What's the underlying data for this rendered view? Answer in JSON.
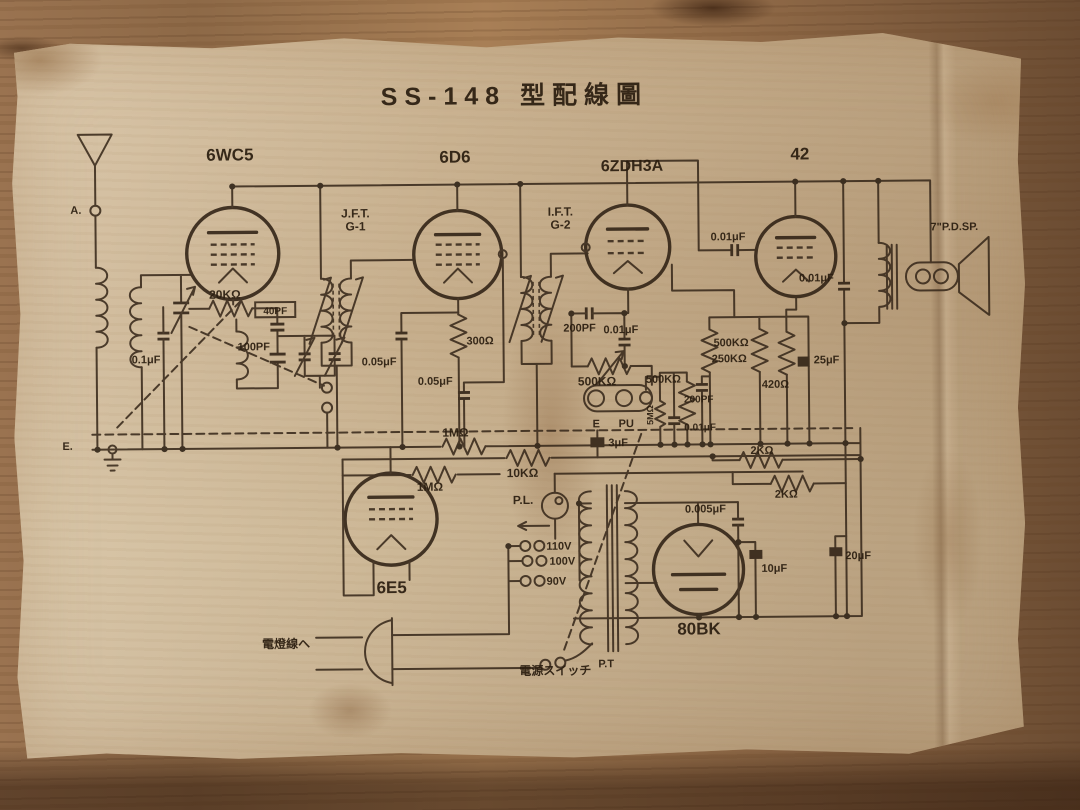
{
  "scene": {
    "description": "Vintage Japanese vacuum-tube radio wiring diagram (SS-148) printed on aged paper lying on a wooden table",
    "paper_color": "#c9b392",
    "wood_color": "#8d6947",
    "ink_color": "#38291b"
  },
  "schematic": {
    "title": "SS-148 型配線圖",
    "labels": [
      {
        "n": "schematic-title",
        "t": "SS-148 型配線圖",
        "x": 505,
        "y": 70,
        "s": 25,
        "a": "m",
        "ls": 7
      },
      {
        "n": "tube-label-6wc5",
        "t": "6WC5",
        "x": 220,
        "y": 124,
        "s": 17,
        "a": "m"
      },
      {
        "n": "tube-label-6d6",
        "t": "6D6",
        "x": 445,
        "y": 128,
        "s": 17,
        "a": "m"
      },
      {
        "n": "tube-label-6zdh3a",
        "t": "6ZDH3A",
        "x": 622,
        "y": 138,
        "s": 16,
        "a": "m"
      },
      {
        "n": "tube-label-42",
        "t": "42",
        "x": 790,
        "y": 128,
        "s": 17,
        "a": "m"
      },
      {
        "n": "tube-label-6e5",
        "t": "6E5",
        "x": 378,
        "y": 558,
        "s": 17,
        "a": "m"
      },
      {
        "n": "tube-label-80bk",
        "t": "80BK",
        "x": 685,
        "y": 602,
        "s": 17,
        "a": "m"
      },
      {
        "n": "label-jft",
        "t": "J.F.T.",
        "x": 345,
        "y": 182,
        "s": 12,
        "a": "m"
      },
      {
        "n": "label-jft-g1",
        "t": "G-1",
        "x": 345,
        "y": 195,
        "s": 12,
        "a": "m"
      },
      {
        "n": "label-ift",
        "t": "I.F.T.",
        "x": 550,
        "y": 182,
        "s": 12,
        "a": "m"
      },
      {
        "n": "label-ift-g2",
        "t": "G-2",
        "x": 550,
        "y": 195,
        "s": 12,
        "a": "m"
      },
      {
        "n": "label-speaker",
        "t": "7\"P.D.SP.",
        "x": 920,
        "y": 200,
        "s": 11
      },
      {
        "n": "label-terminal-a",
        "t": "A.",
        "x": 60,
        "y": 176,
        "s": 11
      },
      {
        "n": "label-terminal-e",
        "t": "E.",
        "x": 50,
        "y": 412,
        "s": 11
      },
      {
        "n": "label-cap-0-1uf",
        "t": "0.1μF",
        "x": 120,
        "y": 326,
        "s": 11
      },
      {
        "n": "label-res-20k",
        "t": "20KΩ",
        "x": 198,
        "y": 262,
        "s": 12
      },
      {
        "n": "label-cap-40pf",
        "t": "40PF",
        "x": 264,
        "y": 278,
        "s": 10,
        "a": "m"
      },
      {
        "n": "label-cap-100pf",
        "t": "100PF",
        "x": 226,
        "y": 314,
        "s": 11
      },
      {
        "n": "label-cap-005uf-1",
        "t": "0.05μF",
        "x": 350,
        "y": 330,
        "s": 11
      },
      {
        "n": "label-res-300",
        "t": "300Ω",
        "x": 455,
        "y": 310,
        "s": 11
      },
      {
        "n": "label-cap-005uf-2",
        "t": "0.05μF",
        "x": 406,
        "y": 350,
        "s": 11
      },
      {
        "n": "label-cap-200pf-1",
        "t": "200PF",
        "x": 552,
        "y": 298,
        "s": 11
      },
      {
        "n": "label-cap-001uf-1",
        "t": "0.01μF",
        "x": 592,
        "y": 300,
        "s": 11
      },
      {
        "n": "label-pot-500k",
        "t": "500KΩ",
        "x": 566,
        "y": 352,
        "s": 12
      },
      {
        "n": "label-jack-e",
        "t": "E",
        "x": 584,
        "y": 394,
        "s": 11,
        "a": "m"
      },
      {
        "n": "label-jack-pu",
        "t": "PU",
        "x": 614,
        "y": 394,
        "s": 11,
        "a": "m"
      },
      {
        "n": "label-res-500k-avc",
        "t": "500KΩ",
        "x": 634,
        "y": 350,
        "s": 11
      },
      {
        "n": "label-res-5m",
        "t": "5MΩ",
        "x": 641,
        "y": 392,
        "s": 9,
        "r": -90
      },
      {
        "n": "label-cap-001uf-2",
        "t": "0.01μF",
        "x": 672,
        "y": 398,
        "s": 10
      },
      {
        "n": "label-res-500k-b",
        "t": "500KΩ",
        "x": 702,
        "y": 314,
        "s": 11
      },
      {
        "n": "label-res-250k",
        "t": "250KΩ",
        "x": 700,
        "y": 330,
        "s": 11
      },
      {
        "n": "label-cap-200pf-2",
        "t": "200PF",
        "x": 672,
        "y": 370,
        "s": 10
      },
      {
        "n": "label-res-420",
        "t": "420Ω",
        "x": 750,
        "y": 356,
        "s": 11
      },
      {
        "n": "label-cap-25uf",
        "t": "25μF",
        "x": 802,
        "y": 332,
        "s": 11
      },
      {
        "n": "label-cap-001uf-3",
        "t": "0.01μF",
        "x": 700,
        "y": 208,
        "s": 11
      },
      {
        "n": "label-cap-001uf-4",
        "t": "0.01μF",
        "x": 788,
        "y": 250,
        "s": 11
      },
      {
        "n": "label-cap-3uf",
        "t": "3μF",
        "x": 596,
        "y": 413,
        "s": 11
      },
      {
        "n": "label-res-2k-1",
        "t": "2KΩ",
        "x": 738,
        "y": 422,
        "s": 11
      },
      {
        "n": "label-res-2k-2",
        "t": "2KΩ",
        "x": 762,
        "y": 466,
        "s": 11
      },
      {
        "n": "label-res-1m-1",
        "t": "1MΩ",
        "x": 430,
        "y": 402,
        "s": 12
      },
      {
        "n": "label-res-1m-2",
        "t": "1MΩ",
        "x": 404,
        "y": 456,
        "s": 12
      },
      {
        "n": "label-res-10k",
        "t": "10KΩ",
        "x": 494,
        "y": 443,
        "s": 12
      },
      {
        "n": "label-pl",
        "t": "P.L.",
        "x": 500,
        "y": 470,
        "s": 12
      },
      {
        "n": "label-tap-110v",
        "t": "110V",
        "x": 533,
        "y": 516,
        "s": 11
      },
      {
        "n": "label-tap-100v",
        "t": "100V",
        "x": 536,
        "y": 531,
        "s": 11
      },
      {
        "n": "label-tap-90v",
        "t": "90V",
        "x": 533,
        "y": 551,
        "s": 11
      },
      {
        "n": "label-cap-0005uf",
        "t": "0.005μF",
        "x": 672,
        "y": 480,
        "s": 11
      },
      {
        "n": "label-cap-10uf",
        "t": "10μF",
        "x": 748,
        "y": 540,
        "s": 11
      },
      {
        "n": "label-cap-20uf",
        "t": "20μF",
        "x": 832,
        "y": 528,
        "s": 11
      },
      {
        "n": "label-pt",
        "t": "P.T",
        "x": 584,
        "y": 634,
        "s": 11
      },
      {
        "n": "label-power-cord",
        "t": "電燈線へ",
        "x": 248,
        "y": 612,
        "s": 12
      },
      {
        "n": "label-power-switch",
        "t": "電源スイッチ",
        "x": 505,
        "y": 641,
        "s": 12
      }
    ]
  }
}
